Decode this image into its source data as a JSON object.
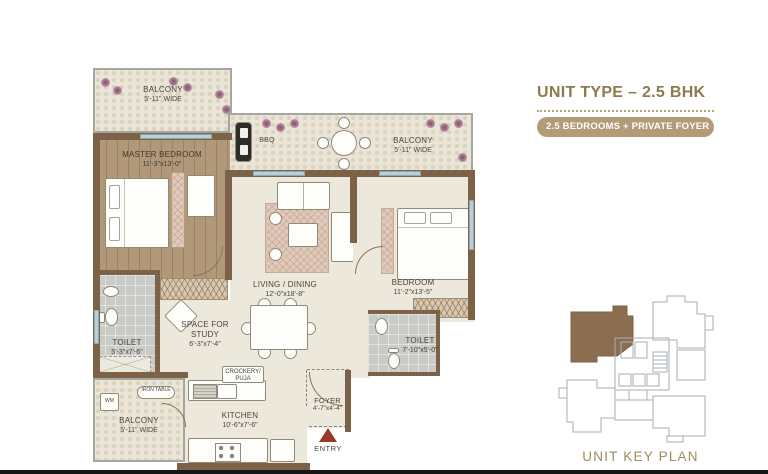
{
  "header": {
    "title": "UNIT TYPE – 2.5 BHK",
    "badge": "2.5 BEDROOMS + PRIVATE FOYER"
  },
  "key_plan": {
    "label": "UNIT KEY PLAN"
  },
  "plan": {
    "balcony_tl": {
      "name": "BALCONY",
      "dim": "5'-11\" WIDE"
    },
    "master_bedroom": {
      "name": "MASTER BEDROOM",
      "dim": "11'-3\"x13'-0\""
    },
    "bbq_label": "BBQ",
    "balcony_tr": {
      "name": "BALCONY",
      "dim": "5'-11\" WIDE"
    },
    "living_dining": {
      "name": "LIVING / DINING",
      "dim": "12'-0\"x18'-8\""
    },
    "bedroom": {
      "name": "BEDROOM",
      "dim": "11'-2\"x13'-5\""
    },
    "toilet_left": {
      "name": "TOILET",
      "dim": "5'-3\"x7'-6\""
    },
    "study": {
      "name": "SPACE FOR STUDY",
      "dim": "6'-3\"x7'-4\""
    },
    "toilet_right": {
      "name": "TOILET",
      "dim": "7'-10\"x5'-0\""
    },
    "crockery": {
      "line1": "CROCKERY/",
      "line2": "PUJA"
    },
    "iron_table": {
      "line1": "IRON",
      "line2": "TABLE"
    },
    "wm_label": "WM",
    "balcony_bottom": {
      "name": "BALCONY",
      "dim": "5'-11\" WIDE"
    },
    "kitchen": {
      "name": "KITCHEN",
      "dim": "10'-6\"x7'-6\""
    },
    "foyer": {
      "name": "FOYER",
      "dim": "4'-7\"x4'-4\""
    },
    "entry_label": "ENTRY"
  },
  "colors": {
    "wall": "#7c6246",
    "accent_gold": "#8d7b50",
    "badge_bg": "#b49b78",
    "entry_arrow": "#993826",
    "key_unit_fill": "#8a6e4f",
    "window": "#b7d0d9"
  }
}
